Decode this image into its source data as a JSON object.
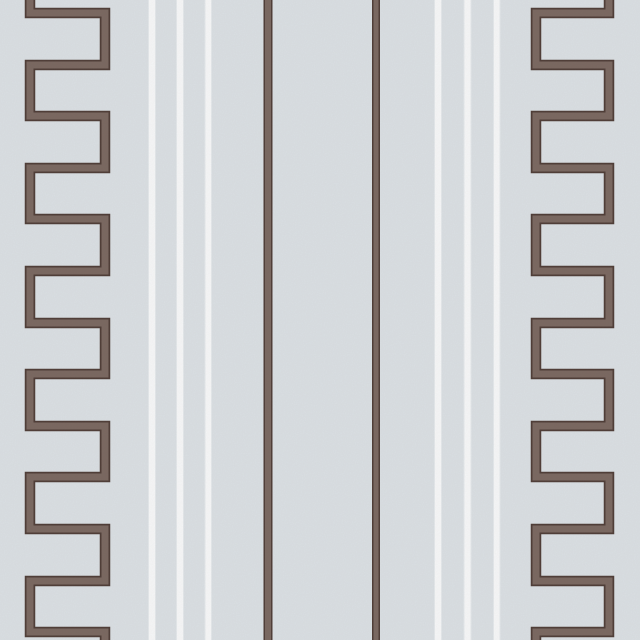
{
  "image": {
    "kind": "wallpaper-swatch-photo",
    "canvas": {
      "width": 640,
      "height": 640
    }
  },
  "colors": {
    "background": "#d9dee2",
    "background_grain": "#cfd5da",
    "ink_dark_edge": "#4e3d37",
    "ink_mid_brown": "#796760",
    "stripe_white": "#f5f7f8"
  },
  "pattern": {
    "stroke_width_outer": 10.5,
    "stroke_width_inner": 7,
    "meanders": [
      {
        "name": "left-greek-key",
        "x_start": 30,
        "x_far": 105,
        "y_top_ext": -8,
        "y_bottom_ext": 648,
        "bar_center_ys": [
          13,
          65,
          116,
          168,
          219,
          271,
          323,
          374,
          426,
          477,
          529,
          581,
          632
        ]
      },
      {
        "name": "right-greek-key",
        "x_start": 609,
        "x_far": 536,
        "y_top_ext": -8,
        "y_bottom_ext": 648,
        "bar_center_ys": [
          13,
          65,
          116,
          168,
          219,
          271,
          323,
          374,
          426,
          477,
          529,
          581,
          632
        ]
      }
    ],
    "white_stripes": [
      {
        "x": 149,
        "width": 6
      },
      {
        "x": 177,
        "width": 6
      },
      {
        "x": 205.5,
        "width": 5.5
      },
      {
        "x": 435,
        "width": 6
      },
      {
        "x": 464.5,
        "width": 6
      },
      {
        "x": 494,
        "width": 5.5
      }
    ],
    "brown_stripes": [
      {
        "x": 263.5,
        "width": 9
      },
      {
        "x": 372,
        "width": 8
      }
    ]
  }
}
